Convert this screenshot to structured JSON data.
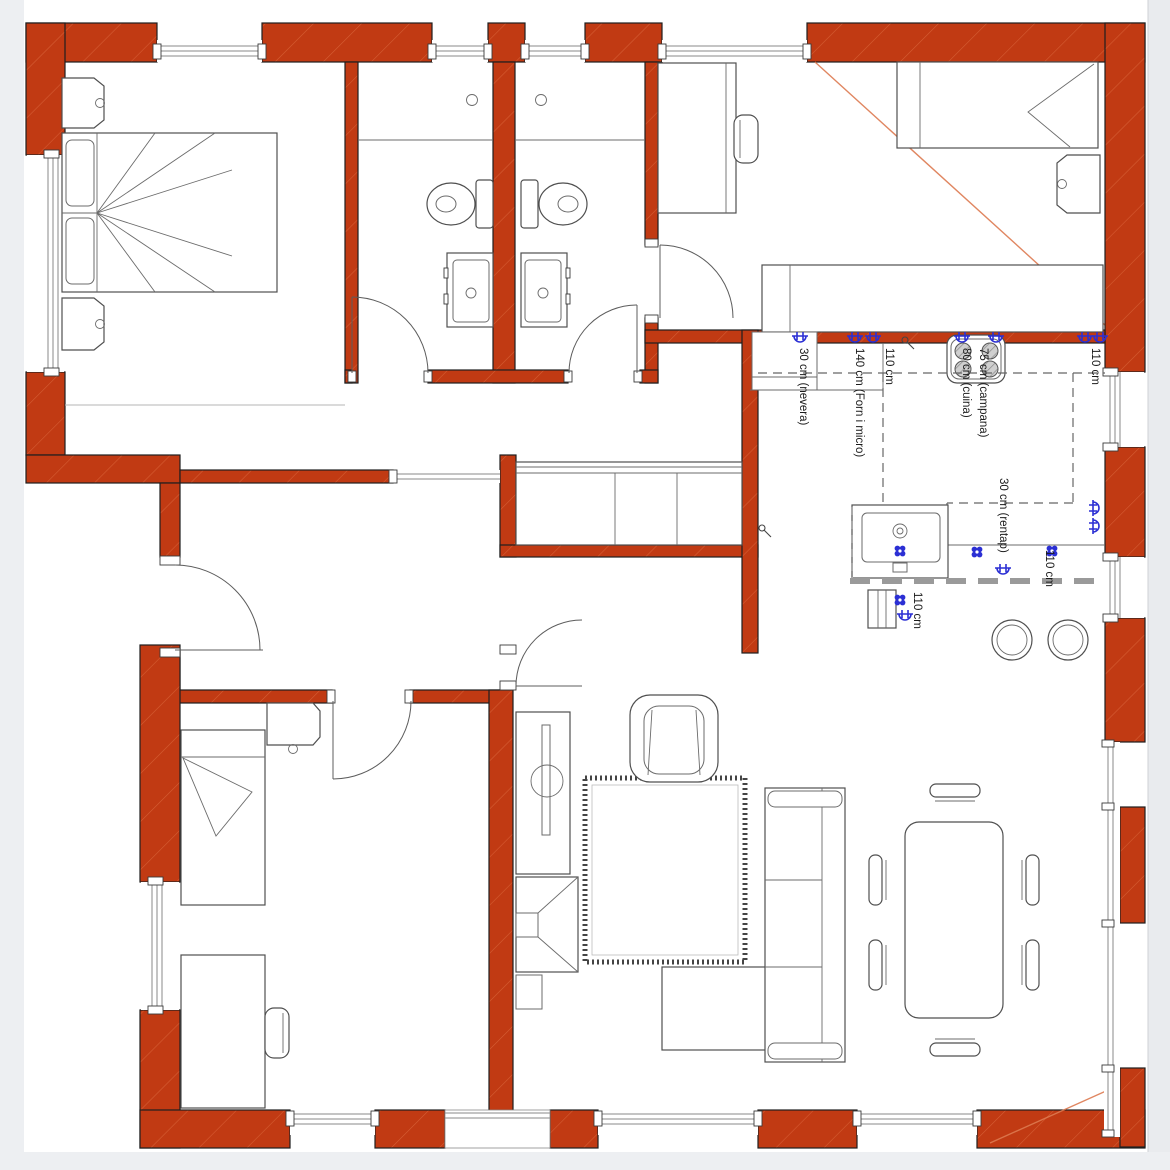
{
  "page": {
    "background": "#ffffff",
    "gutter": "#eceef2"
  },
  "colors": {
    "wall": "#c13a13",
    "wall_hatch": "#dd7a50",
    "outline": "#1e1e1e",
    "furniture_line": "#4f4f4f",
    "glass_line": "#8a8a8a",
    "dash_gray": "#9a9a9a",
    "outlet_blue": "#2b2fd4"
  },
  "annotations": {
    "labels": [
      {
        "id": "nevera",
        "text": "30 cm (nevera)"
      },
      {
        "id": "forn-micro",
        "text": "140 cm (Forn i micro)"
      },
      {
        "id": "c110-top-left",
        "text": "110 cm"
      },
      {
        "id": "cuina",
        "text": "80 cm (cuina)"
      },
      {
        "id": "campana",
        "text": "75 cm (campana)"
      },
      {
        "id": "c110-top-right",
        "text": "110 cm"
      },
      {
        "id": "rentap",
        "text": "30 cm (rentap)"
      },
      {
        "id": "c110-right",
        "text": "110 cm"
      },
      {
        "id": "c110-island",
        "text": "110 cm"
      }
    ]
  }
}
